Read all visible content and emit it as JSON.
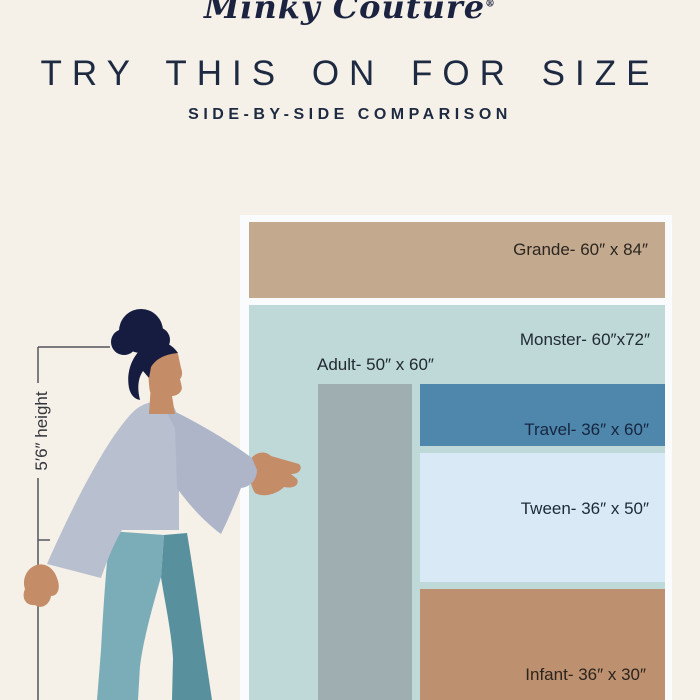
{
  "brand": {
    "name": "Minky Couture",
    "reg": "®"
  },
  "header": {
    "title": "TRY THIS ON FOR SIZE",
    "subtitle": "SIDE-BY-SIDE COMPARISON"
  },
  "figure": {
    "height_label": "5′6″ height"
  },
  "theme": {
    "background": "#f5f1e8",
    "navy": "#1e2a42",
    "frame_white": "#f9fbfd",
    "measure_line": "#55565e"
  },
  "chart_data": {
    "type": "table",
    "title": "TRY THIS ON FOR SIZE",
    "subtitle": "SIDE-BY-SIDE COMPARISON",
    "reference_height": "5′6″ height",
    "blankets": [
      {
        "name": "Grande",
        "label": "Grande- 60″ x 84″",
        "width_in": 60,
        "length_in": 84,
        "color": "#c3a98d",
        "label_color": "#2b2620"
      },
      {
        "name": "Monster",
        "label": "Monster- 60″x72″",
        "width_in": 60,
        "length_in": 72,
        "color": "#bfd9d9",
        "label_color": "#212b31"
      },
      {
        "name": "Adult",
        "label": "Adult- 50″ x 60″",
        "width_in": 50,
        "length_in": 60,
        "color": "#9eaeb1",
        "label_color": "#202a30"
      },
      {
        "name": "Travel",
        "label": "Travel- 36″ x 60″",
        "width_in": 36,
        "length_in": 60,
        "color": "#4e86ac",
        "label_color": "#16263f"
      },
      {
        "name": "Tween",
        "label": "Tween- 36″ x 50″",
        "width_in": 36,
        "length_in": 50,
        "color": "#d9e9f5",
        "label_color": "#1d2b38"
      },
      {
        "name": "Infant",
        "label": "Infant- 36″ x 30″",
        "width_in": 36,
        "length_in": 30,
        "color": "#bd9170",
        "label_color": "#2b241d"
      }
    ]
  }
}
